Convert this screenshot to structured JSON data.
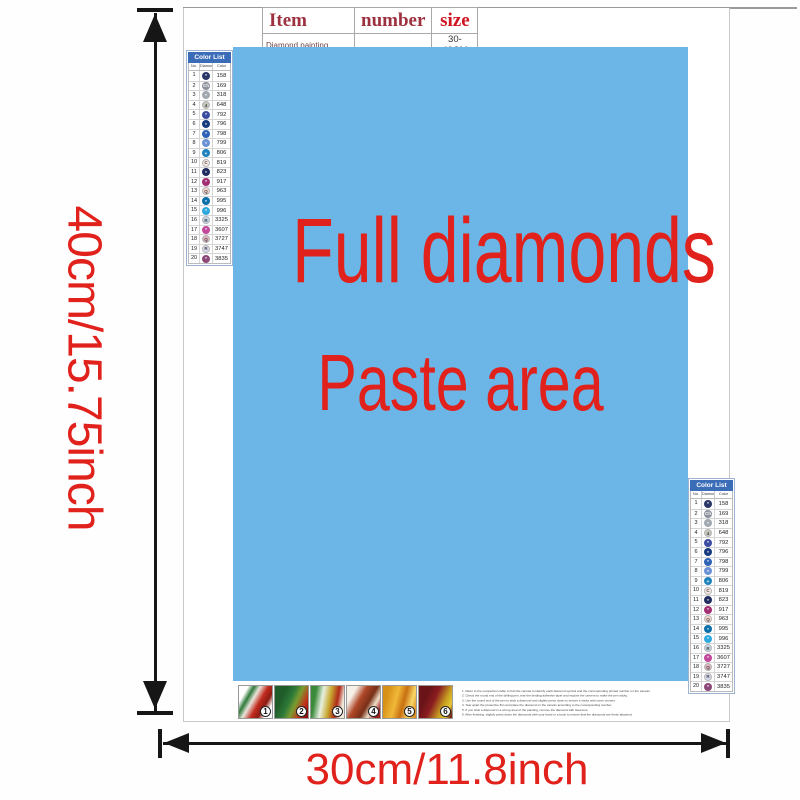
{
  "item_table": {
    "col_item": "Item",
    "col_number": "number",
    "col_size": "size",
    "row_item": "Diamond painting",
    "row_number": "",
    "row_size": "30-40CM"
  },
  "paste_area": {
    "line1": "Full diamonds",
    "line2": "Paste area",
    "bg": "#6cb6e7",
    "text_color": "#e1211b"
  },
  "dims": {
    "height_label": "40cm/15.75inch",
    "width_label": "30cm/11.8inch",
    "color": "#e1211b",
    "arrow_color": "#161616"
  },
  "color_list": {
    "title": "Color List",
    "columns": [
      "No.",
      "Diamond",
      "Color"
    ],
    "header_bg": "#3a6cb8",
    "rows": [
      {
        "no": "1",
        "symbol": "*",
        "code": "158",
        "color": "#2b3766",
        "dark": true
      },
      {
        "no": "2",
        "symbol": "Ch",
        "code": "169",
        "color": "#8b8f9b",
        "dark": true
      },
      {
        "no": "3",
        "symbol": "*",
        "code": "318",
        "color": "#a2a8b0",
        "dark": true
      },
      {
        "no": "4",
        "symbol": "4",
        "code": "648",
        "color": "#c6c7bb",
        "dark": false
      },
      {
        "no": "5",
        "symbol": "*",
        "code": "792",
        "color": "#3c4da1",
        "dark": true
      },
      {
        "no": "6",
        "symbol": "*",
        "code": "796",
        "color": "#173a7e",
        "dark": true
      },
      {
        "no": "7",
        "symbol": "*",
        "code": "798",
        "color": "#2f63b5",
        "dark": true
      },
      {
        "no": "8",
        "symbol": "*",
        "code": "799",
        "color": "#6b92d4",
        "dark": true
      },
      {
        "no": "9",
        "symbol": "+",
        "code": "806",
        "color": "#1e83bd",
        "dark": true
      },
      {
        "no": "10",
        "symbol": "C",
        "code": "819",
        "color": "#f8e8e4",
        "dark": false
      },
      {
        "no": "11",
        "symbol": "*",
        "code": "823",
        "color": "#202c5f",
        "dark": true
      },
      {
        "no": "12",
        "symbol": "*",
        "code": "917",
        "color": "#a42e72",
        "dark": true
      },
      {
        "no": "13",
        "symbol": "Q",
        "code": "963",
        "color": "#f7d5cd",
        "dark": false
      },
      {
        "no": "14",
        "symbol": "*",
        "code": "995",
        "color": "#0b6fa9",
        "dark": true
      },
      {
        "no": "15",
        "symbol": "*",
        "code": "996",
        "color": "#2fa9dd",
        "dark": true
      },
      {
        "no": "16",
        "symbol": "R",
        "code": "3325",
        "color": "#c2d7eb",
        "dark": false
      },
      {
        "no": "17",
        "symbol": "*",
        "code": "3607",
        "color": "#c2489b",
        "dark": true
      },
      {
        "no": "18",
        "symbol": "Q",
        "code": "3727",
        "color": "#e0b4bf",
        "dark": false
      },
      {
        "no": "19",
        "symbol": "R",
        "code": "3747",
        "color": "#d8dcf0",
        "dark": false
      },
      {
        "no": "20",
        "symbol": "*",
        "code": "3835",
        "color": "#8b4878",
        "dark": true
      }
    ]
  },
  "steps": [
    {
      "number": "1",
      "thumb_bg": "linear-gradient(120deg,#ffffff 18%,#2f7a3a 30%,#e8e4da 42%,#c22a1e 58%,#8a1c12 72%,#ffffff 85%)"
    },
    {
      "number": "2",
      "thumb_bg": "linear-gradient(115deg,#1f5c2a 25%,#2e7a38 45%,#7a9c30 60%,#c23018 80%,#8a1010 95%)"
    },
    {
      "number": "3",
      "thumb_bg": "linear-gradient(100deg,#3a8a3a 15%,#e8f0e0 35%,#c8a830 55%,#b02818 75%,#f0e8d8 90%)"
    },
    {
      "number": "4",
      "thumb_bg": "linear-gradient(120deg,#f5f0e8 20%,#b04828 40%,#783018 60%,#f0e0c8 75%,#a02020 90%)"
    },
    {
      "number": "5",
      "thumb_bg": "linear-gradient(105deg,#d89018 15%,#f0b838 40%,#c87010 60%,#f8d868 80%,#e09020 95%)"
    },
    {
      "number": "6",
      "thumb_bg": "linear-gradient(115deg,#6a1418 25%,#8a1c20 45%,#c8a020 70%,#e8c838 85%,#7a2a10 95%)"
    }
  ],
  "instructions": {
    "lines": [
      "1. Refer to the comparison table to find the canvas to identify each diamond symbol and the corresponding printed number on the canvas.",
      "2. Check the round end of the drilling pen, tear the binding adhesive layer and expose the cement to make the pen sticky.",
      "3. Use the round end of the pen to stick a diamond and slightly press down to ensure it sticks with some cement.",
      "4. Tear apart the protective film and place the diamond on the canvas according to the corresponding number.",
      "5. If you stick a diamond in a wrong area of the painting, remove the diamond with tweezers.",
      "6. After finishing, slightly press down the diamonds with your hand or a book to ensure that the diamonds are firmly attached."
    ]
  }
}
